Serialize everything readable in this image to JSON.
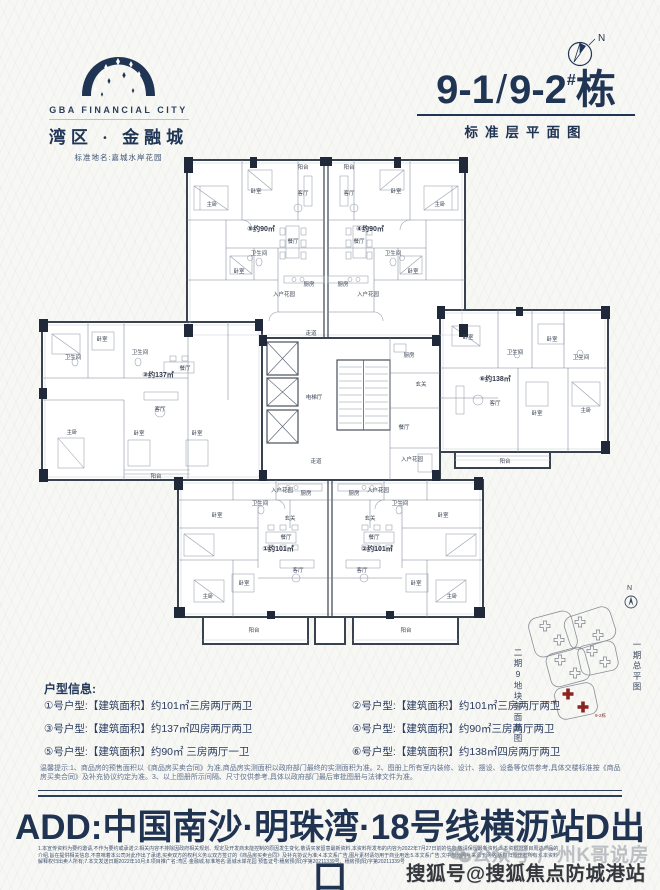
{
  "header": {
    "logo": {
      "brand_en": "GBA FINANCIAL CITY",
      "brand_cn": "湾区 · 金融城",
      "standard_name": "标准地名:嘉城水岸花园"
    },
    "compass_n": "N",
    "title_main": "9-1",
    "title_slash": "/",
    "title_second": "9-2",
    "title_sup": "#",
    "title_suffix": "栋",
    "subtitle": "标准层平面图"
  },
  "plan": {
    "rooms": {
      "master": "主卧",
      "bedroom": "卧室",
      "living": "客厅",
      "dining": "餐厅",
      "kitchen": "厨房",
      "bath": "卫生间",
      "balcony": "阳台",
      "foyer": "玄关",
      "entry_garden": "入户花园",
      "elevator_hall": "电梯厅",
      "corridor": "走道"
    },
    "unit_labels": {
      "u1": "①约101㎡",
      "u2": "②约101㎡",
      "u3": "③约137㎡",
      "u4": "④约90㎡",
      "u5": "⑤约90㎡",
      "u6": "⑥约138㎡"
    }
  },
  "site_map": {
    "left_caption": "二期9地块平面总图",
    "right_caption": "一期总平图",
    "north": "N",
    "towers": [
      "9-1栋",
      "9-2栋"
    ]
  },
  "info": {
    "heading": "户型信息:",
    "items": [
      "①号户型:【建筑面积】约101㎡三房两厅两卫",
      "②号户型:【建筑面积】约101㎡三房两厅两卫",
      "③号户型:【建筑面积】约137㎡四房两厅两卫",
      "④号户型:【建筑面积】约90㎡三房两厅两卫",
      "⑤号户型:【建筑面积】约90㎡ 三房两厅一卫",
      "⑥号户型:【建筑面积】约138㎡四房两厅两卫"
    ]
  },
  "notice": "温馨提示:1、商品房的预售面积以《商品房买卖合同》为准,商品房实测面积以政府部门最终的实测面积为准。2、图册上所有室内装修、设计、摆设、设备等仅供参考,具体交楼标准按《商品房买卖合同》及补充协议约定为准。3、以上图册所示间隔、尺寸仅供参考,具体以政府部门最后审批图册与法律文件为准。",
  "address": "ADD:中国南沙·明珠湾·18号线横沥站D出口",
  "fine_print": [
    "1.本宣传资料为要约邀请,不作为要约或承诺;2.相关内容不排除因政府相关规划、规定及开发商未能控制的原因发生变化,敬请买家留意最新资料,本资料所发布的内容为2022年7月27日前的信息,敬请保留最新资料;3.本资料对项目周边产品的",
    "介绍,旨在提供相关信息,不意味着本公司对此作出了承诺,买卖双方的权利义务以双方签订的《商品房买卖合同》及补充协议为准;4.本文系广告,图片素材请勿用于商业用途;5.本文系广告,文中部分图片来源于网络,版权归原作者所有;6.本资料",
    "解释权归出卖人所有;7.本文发送日期2022年10月;8.项目推广名:湾区·金融城,标准地名:嘉城水岸花园 预售证号:穗房预(阳)字第20211339号、穗房预(阳)字第20211339号"
  ],
  "watermarks": {
    "wechat": "公众号·广州K哥说房",
    "sohu": "搜狐号@搜狐焦点防城港站"
  },
  "colors": {
    "navy": "#203454",
    "red": "#8b2420"
  }
}
